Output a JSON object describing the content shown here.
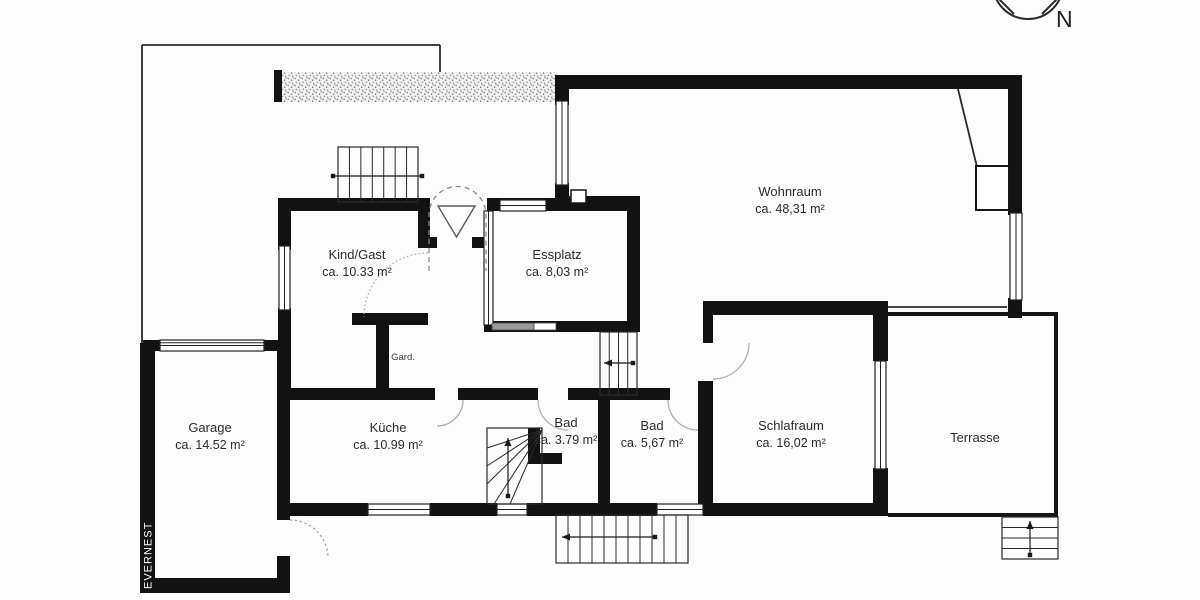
{
  "meta": {
    "background_color": "#fdfdfd",
    "wall_color": "#121212",
    "thin_line_color": "#2a2a2a",
    "door_arc_color": "#a8a8a8",
    "label_color": "#2b2b2b",
    "hatch_color": "#8f8f8f"
  },
  "compass": {
    "label": "N"
  },
  "watermark": {
    "label": "EVERNEST"
  },
  "rooms": [
    {
      "name": "Wohnraum",
      "area": "ca. 48,31 m²",
      "x": 790,
      "y": 196
    },
    {
      "name": "Kind/Gast",
      "area": "ca. 10.33 m²",
      "x": 357,
      "y": 259
    },
    {
      "name": "Essplatz",
      "area": "ca. 8,03 m²",
      "x": 557,
      "y": 259
    },
    {
      "name": "Garage",
      "area": "ca. 14.52 m²",
      "x": 210,
      "y": 432
    },
    {
      "name": "Küche",
      "area": "ca. 10.99 m²",
      "x": 388,
      "y": 432
    },
    {
      "name": "Bad",
      "area": "ca. 3.79 m²",
      "x": 566,
      "y": 427
    },
    {
      "name": "Bad",
      "area": "ca. 5,67 m²",
      "x": 652,
      "y": 430
    },
    {
      "name": "Schlafraum",
      "area": "ca. 16,02 m²",
      "x": 791,
      "y": 430
    },
    {
      "name": "Terrasse",
      "area": "",
      "x": 975,
      "y": 442
    },
    {
      "name": "Gard.",
      "area": "",
      "x": 403,
      "y": 360,
      "small": true
    }
  ],
  "plan": {
    "walls": [
      [
        555,
        75,
        467,
        14
      ],
      [
        555,
        75,
        14,
        30
      ],
      [
        555,
        183,
        14,
        26
      ],
      [
        555,
        196,
        85,
        13
      ],
      [
        1008,
        75,
        14,
        140
      ],
      [
        1008,
        298,
        14,
        20
      ],
      [
        278,
        198,
        152,
        13
      ],
      [
        278,
        198,
        13,
        52
      ],
      [
        278,
        308,
        13,
        86
      ],
      [
        418,
        209,
        12,
        39
      ],
      [
        418,
        237,
        19,
        11
      ],
      [
        472,
        237,
        15,
        11
      ],
      [
        352,
        313,
        76,
        12
      ],
      [
        376,
        313,
        13,
        85
      ],
      [
        487,
        198,
        153,
        13
      ],
      [
        627,
        198,
        13,
        134
      ],
      [
        484,
        321,
        156,
        11
      ],
      [
        290,
        388,
        145,
        12
      ],
      [
        458,
        388,
        70,
        12
      ],
      [
        528,
        388,
        10,
        12
      ],
      [
        568,
        388,
        32,
        12
      ],
      [
        598,
        388,
        12,
        117
      ],
      [
        610,
        388,
        60,
        12
      ],
      [
        698,
        381,
        15,
        124
      ],
      [
        703,
        301,
        10,
        42
      ],
      [
        705,
        301,
        183,
        14
      ],
      [
        873,
        301,
        15,
        60
      ],
      [
        873,
        468,
        15,
        47
      ],
      [
        278,
        503,
        90,
        13
      ],
      [
        430,
        503,
        67,
        13
      ],
      [
        527,
        503,
        130,
        13
      ],
      [
        703,
        503,
        185,
        13
      ],
      [
        140,
        343,
        15,
        250
      ],
      [
        140,
        578,
        150,
        15
      ],
      [
        277,
        340,
        13,
        180
      ],
      [
        277,
        556,
        13,
        24
      ],
      [
        143,
        340,
        147,
        11
      ],
      [
        274,
        70,
        8,
        32
      ],
      [
        528,
        428,
        12,
        34
      ],
      [
        528,
        453,
        34,
        11
      ],
      [
        484,
        211,
        9,
        9
      ],
      [
        484,
        262,
        9,
        18
      ],
      [
        484,
        316,
        9,
        9
      ]
    ],
    "windows": [
      {
        "r": [
          556,
          101,
          12,
          84
        ],
        "o": "v"
      },
      {
        "r": [
          1010,
          213,
          12,
          87
        ],
        "o": "v"
      },
      {
        "r": [
          279,
          246,
          11,
          64
        ],
        "o": "v"
      },
      {
        "r": [
          500,
          200,
          46,
          11
        ],
        "o": "h"
      },
      {
        "r": [
          368,
          504,
          62,
          11
        ],
        "o": "h"
      },
      {
        "r": [
          497,
          504,
          30,
          11
        ],
        "o": "h"
      },
      {
        "r": [
          657,
          504,
          46,
          11
        ],
        "o": "h"
      },
      {
        "r": [
          875,
          361,
          11,
          108
        ],
        "o": "v"
      },
      {
        "r": [
          160,
          340,
          104,
          11
        ],
        "o": "h",
        "double": true
      },
      {
        "r": [
          484,
          211,
          9,
          114
        ],
        "o": "v"
      }
    ],
    "white_boxes": [
      {
        "r": [
          571,
          190,
          15,
          13
        ],
        "sw": 1.5
      },
      {
        "r": [
          976,
          166,
          33,
          44
        ],
        "sw": 2
      }
    ],
    "gray_boxes": [
      {
        "r": [
          492,
          323,
          42,
          7
        ],
        "fill": "#9a9a9a"
      },
      {
        "r": [
          534,
          323,
          22,
          7
        ],
        "fill": "#ffffff"
      }
    ],
    "thin_lines": [
      [
        142,
        45,
        142,
        343
      ],
      [
        142,
        45,
        440,
        45
      ],
      [
        440,
        45,
        440,
        72
      ],
      [
        888,
        307,
        1007,
        307
      ],
      [
        958,
        89,
        977,
        167
      ]
    ],
    "terrace": "M888,314 L1056,314 L1056,515 L888,515",
    "hatch": [
      282,
      72,
      275,
      30
    ],
    "stairs": [
      {
        "box": [
          338,
          147,
          80,
          55
        ],
        "treads": "v",
        "n": 6,
        "arrow": {
          "x1": 333,
          "y1": 176,
          "x2": 422,
          "y2": 176,
          "start": "dot",
          "end": "dot"
        }
      },
      {
        "box": [
          600,
          332,
          37,
          63
        ],
        "treads": "v",
        "n": 3,
        "arrow": {
          "x1": 604,
          "y1": 363,
          "x2": 633,
          "y2": 363,
          "start": "head",
          "end": "dot"
        }
      },
      {
        "box": [
          556,
          515,
          132,
          48
        ],
        "treads": "v",
        "n": 10,
        "arrow": {
          "x1": 562,
          "y1": 537,
          "x2": 655,
          "y2": 537,
          "start": "head",
          "end": "dot"
        }
      },
      {
        "box": [
          1002,
          517,
          56,
          42
        ],
        "treads": "h",
        "n": 3,
        "arrow": {
          "x1": 1030,
          "y1": 555,
          "x2": 1030,
          "y2": 521,
          "start": "dot",
          "end": "head"
        }
      },
      {
        "box": [
          487,
          428,
          55,
          76
        ],
        "treads": "fan",
        "n": 5,
        "arrow": {
          "x1": 508,
          "y1": 496,
          "x2": 508,
          "y2": 438,
          "start": "dot",
          "end": "head"
        }
      }
    ],
    "fan_pivot": [
      542,
      430
    ],
    "fan_ends": [
      [
        487,
        448
      ],
      [
        487,
        466
      ],
      [
        487,
        484
      ],
      [
        494,
        504
      ],
      [
        510,
        504
      ]
    ],
    "door_arcs": [
      {
        "d": "M429,271 L429,215 A28.5,28.5 0 0 1 486,215 L486,271",
        "dash": "5,4",
        "c": "#8a8a8a"
      },
      {
        "d": "M428,253 A64,64 0 0 0 364,317",
        "dash": "1.5,2.5",
        "c": "#aaaaaa"
      },
      {
        "d": "M463,400 A26,26 0 0 1 437,426",
        "dash": "",
        "c": "#b0b0b0"
      },
      {
        "d": "M538,400 A30,30 0 0 0 568,430",
        "dash": "",
        "c": "#b0b0b0"
      },
      {
        "d": "M668,400 A30,30 0 0 0 698,430",
        "dash": "",
        "c": "#b0b0b0"
      },
      {
        "d": "M713,379 A36,36 0 0 0 749,343",
        "dash": "",
        "c": "#b0b0b0"
      },
      {
        "d": "M290,520 A38,38 0 0 1 328,558",
        "dash": "2,3",
        "c": "#9a9a9a"
      }
    ],
    "entrance_triangle": "M438,206 L475,206 L456.5,237 Z",
    "compass_circle": {
      "cx": 1028,
      "cy": -16,
      "r": 35
    },
    "compass_lines": [
      [
        997,
        -3,
        1014,
        14
      ],
      [
        1042,
        14,
        1059,
        -3
      ]
    ],
    "compass_label_pos": [
      1056,
      27
    ],
    "watermark_pos": [
      151.5,
      589
    ]
  }
}
